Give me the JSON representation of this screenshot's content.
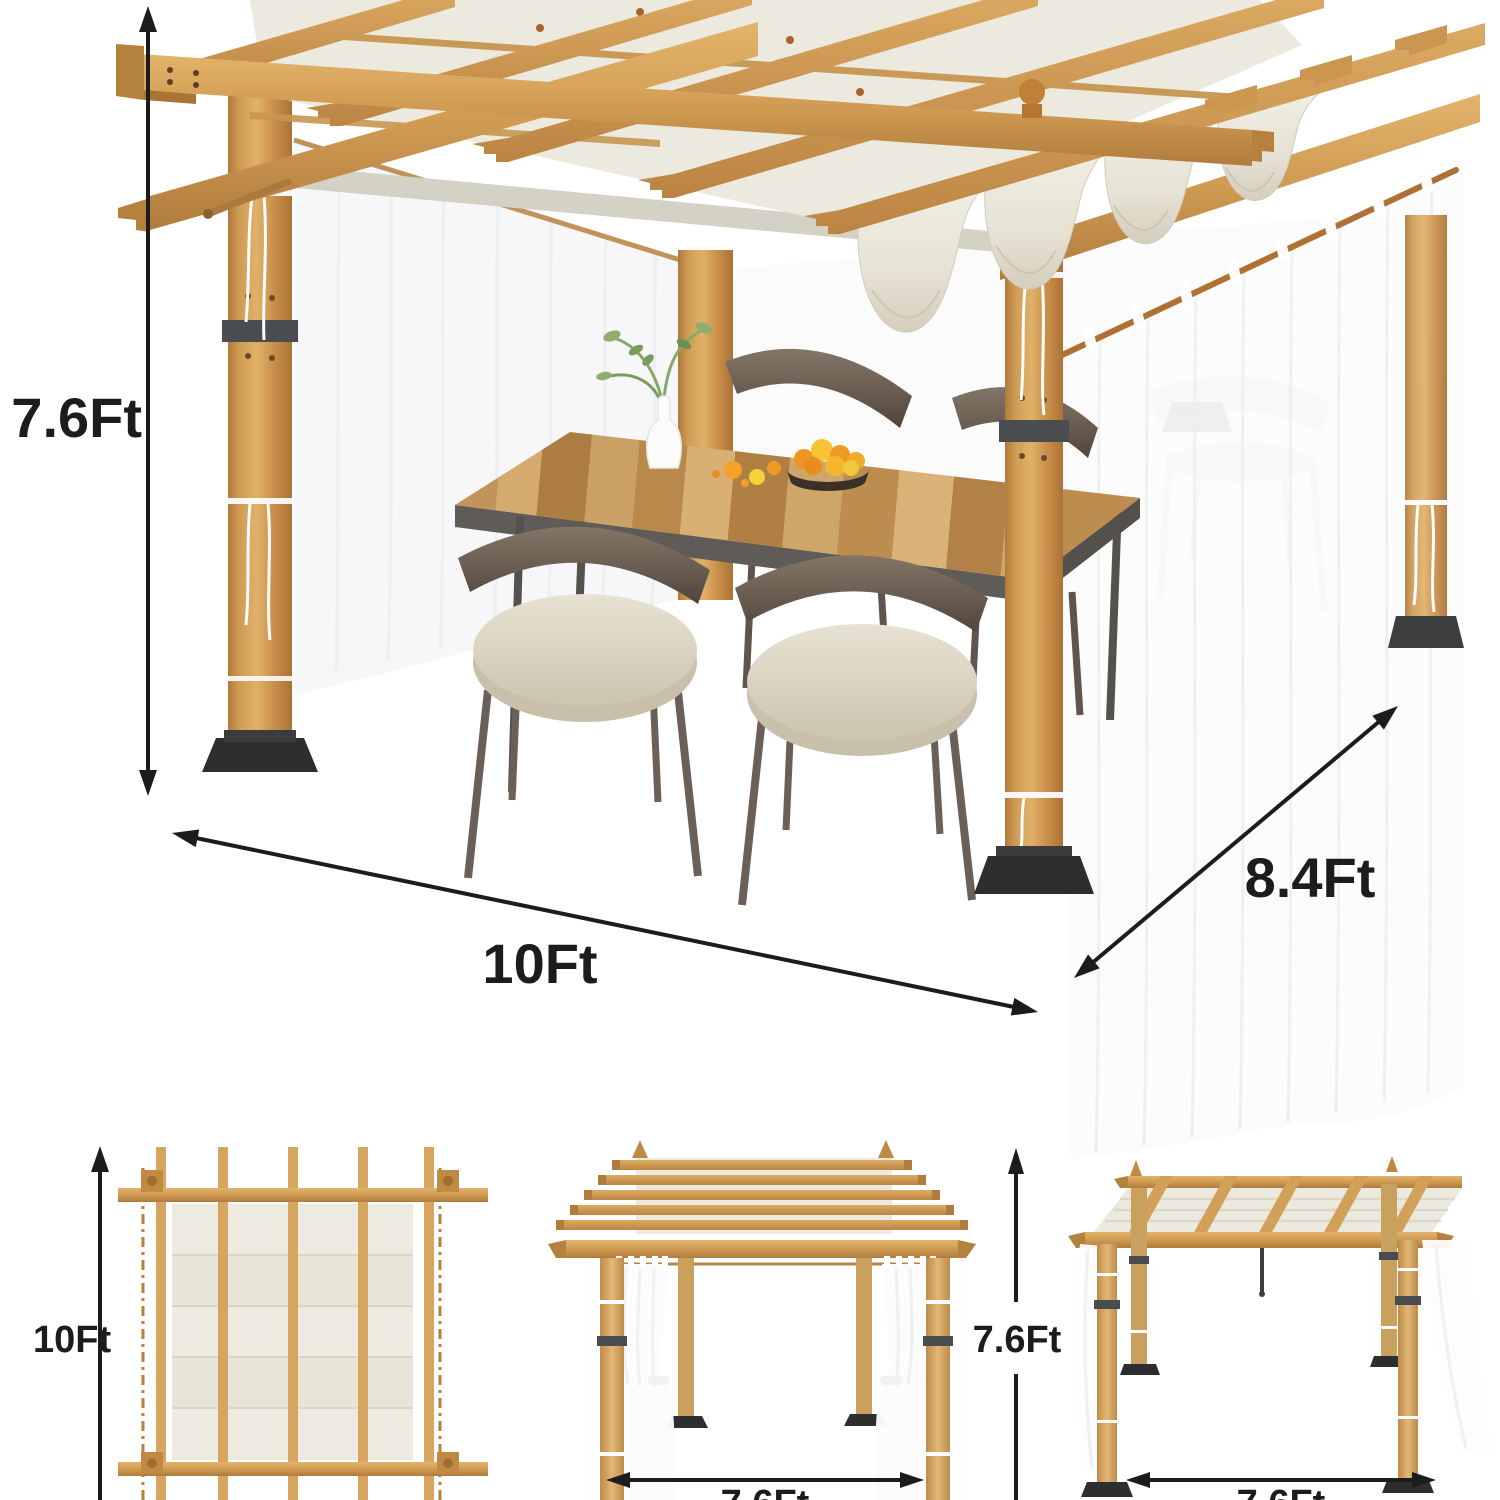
{
  "image_type": "product-dimension-diagram",
  "colors": {
    "background": "#ffffff",
    "wood": "#cf9a52",
    "wood_light": "#e0b169",
    "wood_dark": "#a97434",
    "canopy_fabric": "#ece9de",
    "curtain": "#fbfbfc",
    "metal_bracket": "#4a4d50",
    "base_plate": "#2c2e30",
    "chair_frame": "#6b5e52",
    "cushion": "#ded7c8",
    "fruit_orange": "#f09a26",
    "fruit_lemon": "#f6d13a",
    "plant_green": "#86a96a",
    "annotation_text": "#1c1c1c"
  },
  "annotations": {
    "main": {
      "height": "7.6Ft",
      "width": "10Ft",
      "depth": "8.4Ft"
    },
    "top_view": {
      "depth": "10Ft"
    },
    "front_view": {
      "height": "7.6Ft",
      "width": "7.6Ft"
    },
    "side_view": {
      "width": "7.6Ft"
    }
  }
}
